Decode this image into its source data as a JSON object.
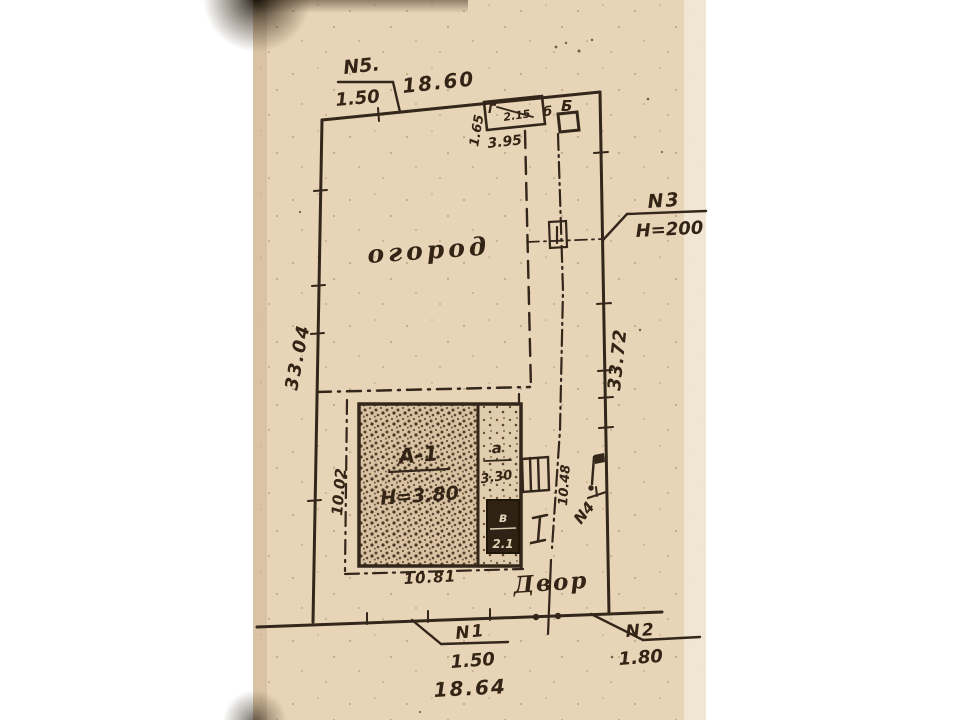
{
  "plan": {
    "callouts": {
      "n5": {
        "label": "N5.",
        "value": "1.50"
      },
      "n3": {
        "label": "N3",
        "value": "H=200"
      },
      "n4": {
        "label": "N4"
      },
      "n1": {
        "label": "N1",
        "value": "1.50"
      },
      "n2": {
        "label": "N2",
        "value": "1.80"
      }
    },
    "dimensions": {
      "top_boundary": "18.60",
      "left_boundary": "33.04",
      "right_boundary": "33.72",
      "left_inner": "10.02",
      "yard_bottom": "10.81",
      "street_front": "18.64",
      "walkway": "10.48",
      "shed_front": "3.95",
      "shed_side": "1.65",
      "shed_inner": "2.15"
    },
    "areas": {
      "garden": "огород",
      "yard": "Двор"
    },
    "structures": {
      "house_label": "А-1",
      "house_height": "H=3.80",
      "annex_label": "а",
      "annex_size": "3.30",
      "extension_label": "в",
      "extension_size": "2.1",
      "shed_label": "Г",
      "outbuilding_small_label": "б",
      "outbuilding_label": "Б"
    },
    "colors": {
      "paper": "#e8d4b6",
      "ink": "#33261a"
    }
  }
}
